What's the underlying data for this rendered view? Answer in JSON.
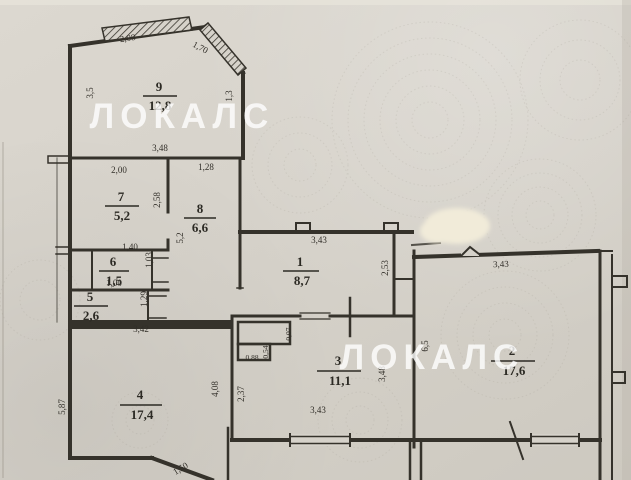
{
  "plan": {
    "watermark_text": "ЛОКАЛС",
    "colors": {
      "paper": "#d6d2ca",
      "ink": "#35322b",
      "watermark": "#ffffff",
      "whiteout": "#f1ebd9"
    },
    "rooms": {
      "r1": {
        "num": "1",
        "area": "8,7"
      },
      "r2": {
        "num": "2",
        "area": "17,6"
      },
      "r3": {
        "num": "3",
        "area": "11,1"
      },
      "r4": {
        "num": "4",
        "area": "17,4"
      },
      "r5": {
        "num": "5",
        "area": "2,6"
      },
      "r6": {
        "num": "6",
        "area": "1,5"
      },
      "r7": {
        "num": "7",
        "area": "5,2"
      },
      "r8": {
        "num": "8",
        "area": "6,6"
      },
      "r9": {
        "num": "9",
        "area": "12,8"
      }
    },
    "dims": {
      "room9_top": "2,08",
      "room9_chamfer": "1,70",
      "room9_bottom": "3,48",
      "room9_left": "3,5",
      "room9_right": "1,3",
      "room7_top": "2,00",
      "room7_right": "2,58",
      "room8_top": "1,28",
      "room8_left": "5,2",
      "room6_top": "1,40",
      "room6_right": "1,03",
      "room5_top": "1,00",
      "room5_right": "1,29",
      "room1_top": "3,43",
      "room1_right": "2,53",
      "room2_top": "3,43",
      "room2_left": "6,5",
      "room3_left": "2,37",
      "room3_right": "3,48",
      "room3_bottom": "3,43",
      "room4_top": "3,42",
      "room4_left": "5,87",
      "room4_right": "4,08",
      "room4_diag": "1,50",
      "shaft_right": "0,07",
      "shaft_mid": "0,54",
      "shaft_bottom": "0,88"
    }
  }
}
